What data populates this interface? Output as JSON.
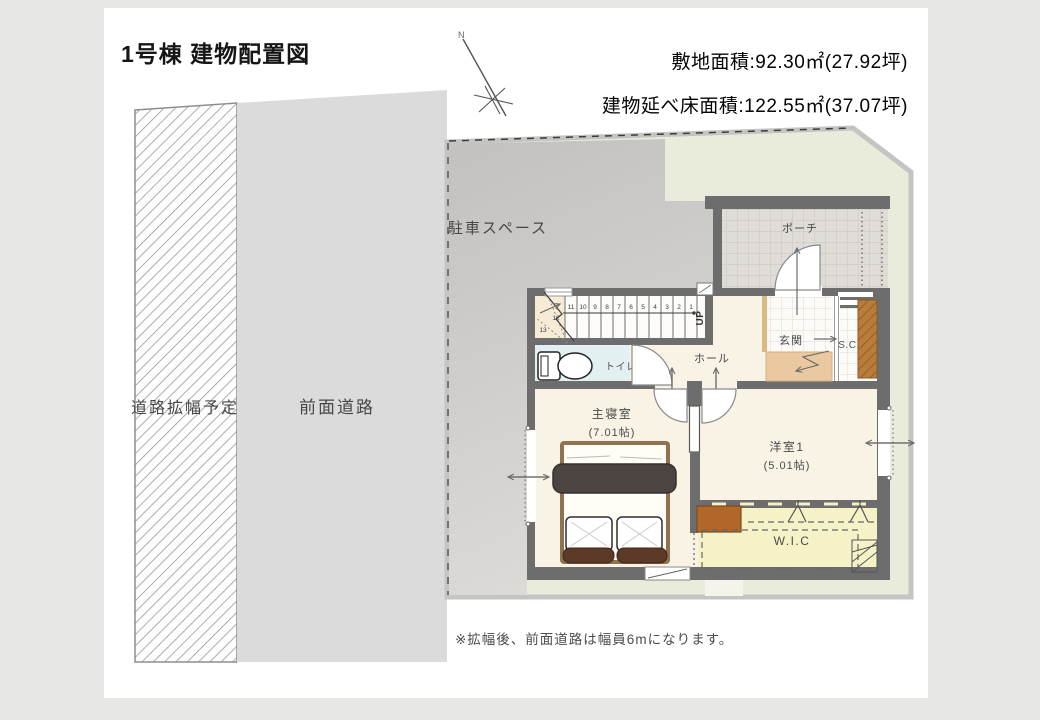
{
  "page": {
    "title": "1号棟 建物配置図",
    "site_area_label": "敷地面積:92.30㎡(27.92坪)",
    "total_floor_area_label": "建物延べ床面積:122.55㎡(37.07坪)",
    "note": "※拡幅後、前面道路は幅員6mになります。",
    "north_label": "N"
  },
  "site": {
    "road_widening_label": "道路拡幅予定",
    "front_road_label": "前面道路",
    "parking_label": "駐車スペース"
  },
  "rooms": {
    "porch": "ポーチ",
    "entrance": "玄関",
    "shoe_closet": "S.C.",
    "hall": "ホール",
    "toilet": "トイレ",
    "master_bedroom": "主寝室",
    "master_bedroom_size": "(7.01帖)",
    "western_room1": "洋室1",
    "western_room1_size": "(5.01帖)",
    "wic": "W.I.C",
    "stairs_up": "UP"
  },
  "stairs": {
    "numbers": [
      "1",
      "2",
      "3",
      "4",
      "5",
      "6",
      "7",
      "8",
      "9",
      "10",
      "11",
      "12",
      "13"
    ]
  },
  "colors": {
    "wall": "#6d6d6d",
    "lot_green": "#e9ecda",
    "road_gray": "#dbdbdb",
    "parking_gray": "#c7c5c3",
    "floor_cream": "#f8f3e5",
    "toilet_blue": "#e2f0f2",
    "wic_yellow": "#f6f2c8",
    "step_beige": "#eac9a1",
    "closet_brown": "#b5792f",
    "bed_blanket": "#4b4441",
    "bed_bolster": "#5d3a27"
  }
}
